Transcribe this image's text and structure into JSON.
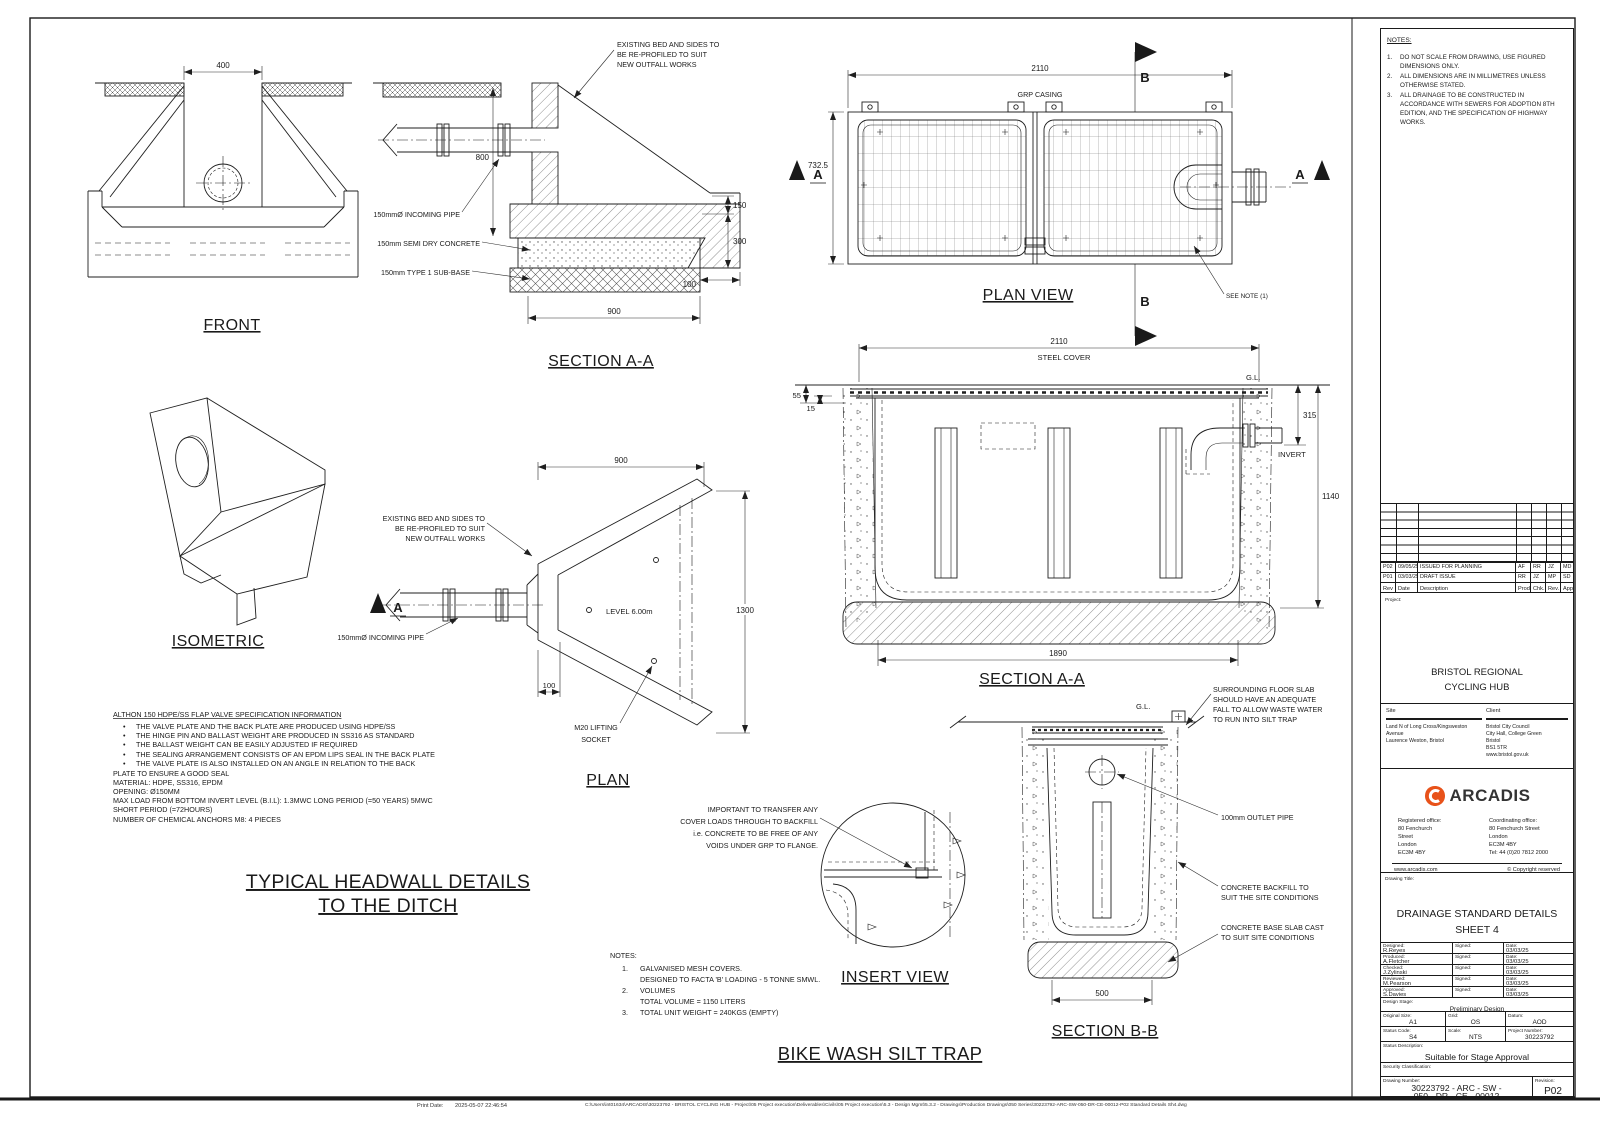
{
  "colors": {
    "accent": "#E8521A",
    "ink": "#1a1a1a"
  },
  "front": {
    "title": "FRONT",
    "d400": "400"
  },
  "sec_top": {
    "title": "SECTION A-A",
    "bed": [
      "EXISTING BED AND SIDES TO",
      "BE RE-PROFILED TO SUIT",
      "NEW OUTFALL WORKS"
    ],
    "pipe": "150mmØ INCOMING PIPE",
    "conc": "150mm  SEMI DRY CONCRETE",
    "sub": "150mm  TYPE 1 SUB-BASE",
    "d800": "800",
    "d150": "150",
    "d300": "300",
    "d100": "100",
    "d900": "900"
  },
  "plan_view": {
    "title": "PLAN VIEW",
    "d2110": "2110",
    "d732": "732.5",
    "grp": "GRP CASING",
    "see_note": "SEE NOTE (1)",
    "a": "A",
    "b": "B"
  },
  "iso": {
    "title": "ISOMETRIC"
  },
  "plan": {
    "title": "PLAN",
    "d900": "900",
    "d1300": "1300",
    "d100": "100",
    "bed": [
      "EXISTING BED AND SIDES TO",
      "BE RE-PROFILED TO SUIT",
      "NEW OUTFALL WORKS"
    ],
    "pipe": "150mmØ INCOMING PIPE",
    "level": "LEVEL 6.00m",
    "m20": [
      "M20 LIFTING",
      "SOCKET"
    ],
    "a": "A"
  },
  "sec_mid": {
    "title": "SECTION A-A",
    "d2110": "2110",
    "steel": "STEEL COVER",
    "gl": "G.L.",
    "d55": "55",
    "d15": "15",
    "d315": "315",
    "invert": "INVERT",
    "d1140": "1140",
    "d1890": "1890"
  },
  "sec_bb": {
    "title": "SECTION B-B",
    "gl": "G.L.",
    "d500": "500",
    "floor": [
      "SURROUNDING FLOOR SLAB",
      "SHOULD HAVE AN ADEQUATE",
      "FALL TO ALLOW WASTE WATER",
      "TO RUN INTO SILT TRAP"
    ],
    "outlet": "100mm OUTLET PIPE",
    "backfill": [
      "CONCRETE BACKFILL TO",
      "SUIT THE SITE CONDITIONS"
    ],
    "base": [
      "CONCRETE BASE SLAB CAST",
      "TO SUIT SITE CONDITIONS"
    ]
  },
  "insert": {
    "title": "INSERT VIEW",
    "note": [
      "IMPORTANT TO TRANSFER ANY",
      "COVER LOADS THROUGH TO BACKFILL",
      "i.e. CONCRETE TO BE FREE OF ANY",
      "VOIDS UNDER GRP TO FLANGE."
    ]
  },
  "althon": {
    "title": "ALTHON 150 HDPE/SS FLAP VALVE SPECIFICATION INFORMATION",
    "bullet": "•",
    "bullets": [
      "THE VALVE PLATE AND THE BACK PLATE ARE PRODUCED USING HDPE/SS",
      "THE HINGE PIN AND BALLAST WEIGHT ARE PRODUCED IN SS316 AS STANDARD",
      "THE BALLAST WEIGHT CAN BE EASILY ADJUSTED IF REQUIRED",
      "THE SEALING ARRANGEMENT CONSISTS OF AN EPDM LIPS SEAL IN THE BACK PLATE",
      "THE VALVE PLATE IS ALSO INSTALLED ON AN ANGLE IN RELATION TO THE BACK"
    ],
    "lines": [
      "PLATE TO ENSURE A GOOD SEAL",
      "MATERIAL: HDPE, SS316, EPDM",
      "OPENING:  Ø150MM",
      "MAX LOAD FROM BOTTOM INVERT LEVEL (B.I.L): 1.3MWC LONG PERIOD (=50 YEARS) 5MWC",
      "SHORT PERIOD (=72HOURS)",
      "NUMBER OF CHEMICAL ANCHORS M8: 4 PIECES"
    ]
  },
  "headwall_title": [
    "TYPICAL HEADWALL DETAILS",
    "TO THE DITCH"
  ],
  "main_title": "BIKE WASH SILT TRAP",
  "notes_btm": {
    "title": "NOTES:",
    "n1": "1.",
    "l1": "GALVANISED MESH COVERS.",
    "l1b": "DESIGNED TO FACTA 'B' LOADING - 5 TONNE SMWL.",
    "n2": "2.",
    "l2": "VOLUMES",
    "l2b": "TOTAL VOLUME = 1150 LITERS",
    "n3": "3.",
    "l3": "TOTAL UNIT WEIGHT = 240KGS (EMPTY)"
  },
  "tb": {
    "notes_title": "NOTES:",
    "n1": "1.",
    "n1l": [
      "DO NOT SCALE FROM DRAWING, USE FIGURED",
      "DIMENSIONS ONLY."
    ],
    "n2": "2.",
    "n2l": [
      "ALL DIMENSIONS ARE IN MILLIMETRES UNLESS",
      "OTHERWISE STATED."
    ],
    "n3": "3.",
    "n3l": [
      "ALL DRAINAGE TO BE CONSTRUCTED IN",
      "ACCORDANCE WITH SEWERS FOR ADOPTION 8TH",
      "EDITION, AND THE SPECIFICATION OF HIGHWAY",
      "WORKS."
    ],
    "rev_hdr": {
      "rev": "Rev",
      "date": "Date",
      "desc": "Description",
      "prod": "Prod",
      "chk": "Chk.",
      "revby": "Rev.",
      "app": "App."
    },
    "rev_rows": [
      {
        "rev": "P02",
        "date": "09/05/25",
        "desc": "ISSUED FOR PLANNING",
        "prod": "AF",
        "chk": "RR",
        "revby": "JZ",
        "app": "MD"
      },
      {
        "rev": "P01",
        "date": "03/03/25",
        "desc": "DRAFT ISSUE",
        "prod": "RR",
        "chk": "JZ",
        "revby": "MP",
        "app": "SD"
      }
    ],
    "project_label": "Project:",
    "project": [
      "BRISTOL REGIONAL",
      "CYCLING HUB"
    ],
    "site_label": "Site",
    "site": [
      "Land N of Long Cross/Kingsweston Avenue",
      "Laurence Weston, Bristol"
    ],
    "client_label": "Client",
    "client": [
      "Bristol City Council",
      "City Hall, College Green",
      "Bristol",
      "BS1 5TR",
      "www.bristol.gov.uk"
    ],
    "arcadis": "ARCADIS",
    "reg_label": "Registered office:",
    "reg": [
      "80 Fenchurch",
      "Street",
      "London",
      "EC3M 4BY"
    ],
    "coord_label": "Coordinating office:",
    "coord": [
      "80 Fenchurch Street",
      "London",
      "EC3M 4BY",
      "Tel: 44 (0)20 7812 2000"
    ],
    "web": "www.arcadis.com",
    "copyright": "© Copyright reserved",
    "dt_label": "Drawing Title:",
    "dt": [
      "DRAINAGE STANDARD DETAILS",
      "SHEET 4"
    ],
    "signoff": [
      {
        "role": "Designed:",
        "name": "R.Reyes",
        "signed": "Signed:",
        "datel": "Date:",
        "date": "03/03/25"
      },
      {
        "role": "Produced:",
        "name": "A.Fletcher",
        "signed": "Signed:",
        "datel": "Date:",
        "date": "03/03/25"
      },
      {
        "role": "Checked:",
        "name": "J.Zylinski",
        "signed": "Signed:",
        "datel": "Date:",
        "date": "03/03/25"
      },
      {
        "role": "Reviewed:",
        "name": "M.Pearson",
        "signed": "Signed:",
        "datel": "Date:",
        "date": "03/03/25"
      },
      {
        "role": "Approved:",
        "name": "S.Davies",
        "signed": "Signed:",
        "datel": "Date:",
        "date": "03/03/25"
      }
    ],
    "stage_label": "Design Stage:",
    "stage": "Preliminary Design",
    "size_label": "Original Size:",
    "size": "A1",
    "grid_label": "Grid:",
    "grid": "OS",
    "datum_label": "Datum:",
    "datum": "AOD",
    "status_label": "Status Code:",
    "status": "S4",
    "scale_label": "Scale:",
    "scale": "NTS",
    "pn_label": "Project Number:",
    "pn": "30223792",
    "sd_label": "Status Description:",
    "sd": "Suitable for Stage Approval",
    "sec_label": "Security Classification:",
    "dn_label": "Drawing Number:",
    "dn": [
      "30223792 - ARC - SW -",
      "050 - DR - CE - 00012"
    ],
    "rev_label": "Revision:",
    "rev": "P02"
  },
  "footer": {
    "print_label": "Print Date:",
    "print_date": "2025-05-07 22:46:54",
    "path": "C:\\Users\\int01634\\ARCADIS\\30223792 - BRISTOL CYCLING HUB - Project\\05 Project execution\\Deliverables\\Civils\\05 Project execution\\5.3 - Design Mgmt\\5.3.2 - Drawings\\Production Drawings\\050 Series\\30223792-ARC-SW-050-DR-CE-00012-P02 Standard Details Sh4.dwg"
  }
}
